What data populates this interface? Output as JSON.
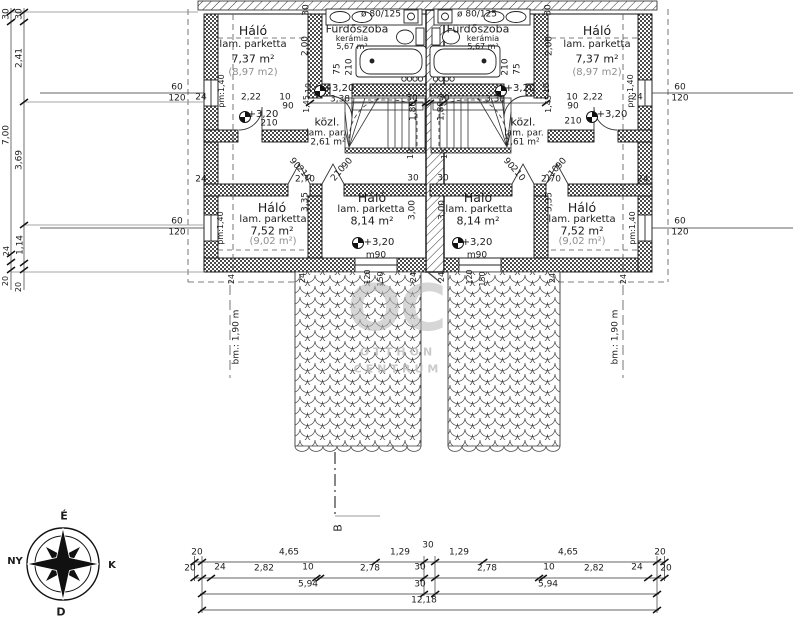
{
  "colors": {
    "line": "#1c1c1c",
    "gray_text": "#8f8f8f",
    "watermark": "#b5b5b5"
  },
  "labels": [
    {
      "n": "room-name-halo-top-left",
      "t": "Háló",
      "x": 253,
      "y": 31,
      "c": "s12"
    },
    {
      "n": "room-floor-halo-top-left",
      "t": "lam. parketta",
      "x": 253,
      "y": 45,
      "c": "s10"
    },
    {
      "n": "room-area-halo-top-left",
      "t": "7,37 m²",
      "x": 253,
      "y": 59,
      "c": "s11"
    },
    {
      "n": "room-area-gross-halo-top-left",
      "t": "(8,97 m2)",
      "x": 253,
      "y": 73,
      "c": "s10 gray"
    },
    {
      "n": "room-name-bathroom-left",
      "t": "Fürdőszoba",
      "x": 357,
      "y": 29,
      "c": "s11"
    },
    {
      "n": "room-floor-bathroom-left",
      "t": "kerámia",
      "x": 352,
      "y": 39,
      "c": "s8"
    },
    {
      "n": "room-area-bathroom-left",
      "t": "5,67 m²",
      "x": 352,
      "y": 47,
      "c": "s8"
    },
    {
      "n": "vent-label-left",
      "t": "ø 80/125",
      "x": 381,
      "y": 15,
      "c": "s9"
    },
    {
      "n": "room-name-hall-left",
      "t": "közl.",
      "x": 327,
      "y": 122,
      "c": "s11"
    },
    {
      "n": "room-floor-hall-left",
      "t": "lam. par.",
      "x": 326,
      "y": 134,
      "c": "s9"
    },
    {
      "n": "room-area-hall-left",
      "t": "2,61 m²",
      "x": 328,
      "y": 143,
      "c": "s9"
    },
    {
      "n": "room-name-halo-bottom-inner-left",
      "t": "Háló",
      "x": 372,
      "y": 198,
      "c": "s12"
    },
    {
      "n": "room-floor-halo-bottom-inner-left",
      "t": "lam. parketta",
      "x": 371,
      "y": 210,
      "c": "s10"
    },
    {
      "n": "room-area-halo-bottom-inner-left",
      "t": "8,14 m²",
      "x": 372,
      "y": 221,
      "c": "s11"
    },
    {
      "n": "level-label",
      "t": "+3,20",
      "x": 379,
      "y": 243,
      "c": "s10"
    },
    {
      "n": "door-label",
      "t": "m90",
      "x": 376,
      "y": 256,
      "c": "s9"
    },
    {
      "n": "room-name-halo-bottom-outer-left",
      "t": "Háló",
      "x": 272,
      "y": 208,
      "c": "s12"
    },
    {
      "n": "room-floor-halo-bottom-outer-left",
      "t": "lam. parketta",
      "x": 273,
      "y": 220,
      "c": "s10"
    },
    {
      "n": "room-area-halo-bottom-outer-left",
      "t": "7,52 m²",
      "x": 272,
      "y": 231,
      "c": "s11"
    },
    {
      "n": "room-area-gross-halo-bottom-outer-left",
      "t": "(9,02 m²)",
      "x": 273,
      "y": 242,
      "c": "s10 gray"
    },
    {
      "n": "room-name-halo-top-right",
      "t": "Háló",
      "x": 597,
      "y": 31,
      "c": "s12"
    },
    {
      "n": "room-floor-halo-top-right",
      "t": "lam. parketta",
      "x": 597,
      "y": 45,
      "c": "s10"
    },
    {
      "n": "room-area-halo-top-right",
      "t": "7,37 m²",
      "x": 597,
      "y": 59,
      "c": "s11"
    },
    {
      "n": "room-area-gross-halo-top-right",
      "t": "(8,97 m2)",
      "x": 597,
      "y": 73,
      "c": "s10 gray"
    },
    {
      "n": "room-name-bathroom-right",
      "t": "Fürdőszoba",
      "x": 478,
      "y": 29,
      "c": "s11"
    },
    {
      "n": "room-floor-bathroom-right",
      "t": "kerámia",
      "x": 483,
      "y": 39,
      "c": "s8"
    },
    {
      "n": "room-area-bathroom-right",
      "t": "5,67 m²",
      "x": 483,
      "y": 47,
      "c": "s8"
    },
    {
      "n": "vent-label-right",
      "t": "ø 80/125",
      "x": 477,
      "y": 15,
      "c": "s9"
    },
    {
      "n": "room-name-hall-right",
      "t": "közl.",
      "x": 523,
      "y": 122,
      "c": "s11"
    },
    {
      "n": "room-floor-hall-right",
      "t": "lam. par.",
      "x": 524,
      "y": 134,
      "c": "s9"
    },
    {
      "n": "room-area-hall-right",
      "t": "2,61 m²",
      "x": 522,
      "y": 143,
      "c": "s9"
    },
    {
      "n": "room-name-halo-bottom-inner-right",
      "t": "Háló",
      "x": 478,
      "y": 198,
      "c": "s12"
    },
    {
      "n": "room-floor-halo-bottom-inner-right",
      "t": "lam. parketta",
      "x": 479,
      "y": 210,
      "c": "s10"
    },
    {
      "n": "room-area-halo-bottom-inner-right",
      "t": "8,14 m²",
      "x": 478,
      "y": 221,
      "c": "s11"
    },
    {
      "n": "level-label",
      "t": "+3,20",
      "x": 477,
      "y": 243,
      "c": "s10"
    },
    {
      "n": "door-label",
      "t": "m90",
      "x": 477,
      "y": 256,
      "c": "s9"
    },
    {
      "n": "room-name-halo-bottom-outer-right",
      "t": "Háló",
      "x": 582,
      "y": 208,
      "c": "s12"
    },
    {
      "n": "room-floor-halo-bottom-outer-right",
      "t": "lam. parketta",
      "x": 582,
      "y": 220,
      "c": "s10"
    },
    {
      "n": "room-area-halo-bottom-outer-right",
      "t": "7,52 m²",
      "x": 582,
      "y": 231,
      "c": "s11"
    },
    {
      "n": "room-area-gross-halo-bottom-outer-right",
      "t": "(9,02 m²)",
      "x": 582,
      "y": 242,
      "c": "s10 gray"
    },
    {
      "n": "dim-label",
      "t": "pm:1,40",
      "x": 222,
      "y": 91,
      "r": -90,
      "c": "s8"
    },
    {
      "n": "dim-label",
      "t": "24",
      "x": 201,
      "y": 98,
      "c": "s9"
    },
    {
      "n": "dim-label",
      "t": "2,22",
      "x": 251,
      "y": 98,
      "c": "s9"
    },
    {
      "n": "dim-label",
      "t": "10",
      "x": 285,
      "y": 98,
      "c": "s9"
    },
    {
      "n": "dim-label",
      "t": "90",
      "x": 288,
      "y": 107,
      "c": "s9"
    },
    {
      "n": "level-label",
      "t": "+3,20",
      "x": 263,
      "y": 115,
      "c": "s10"
    },
    {
      "n": "dim-label",
      "t": "210",
      "x": 269,
      "y": 124,
      "c": "s9"
    },
    {
      "n": "dim-label",
      "t": "1,45",
      "x": 307,
      "y": 104,
      "r": -90,
      "c": "s8"
    },
    {
      "n": "dim-label",
      "t": "10",
      "x": 309,
      "y": 88,
      "r": -90,
      "c": "s8"
    },
    {
      "n": "dim-label",
      "t": "30",
      "x": 307,
      "y": 10,
      "r": -90,
      "c": "s9"
    },
    {
      "n": "dim-label",
      "t": "2,00",
      "x": 306,
      "y": 46,
      "r": -90,
      "c": "s9"
    },
    {
      "n": "dim-label",
      "t": "75",
      "x": 338,
      "y": 69,
      "r": -90,
      "c": "s9"
    },
    {
      "n": "dim-label",
      "t": "210",
      "x": 350,
      "y": 67,
      "r": -90,
      "c": "s9"
    },
    {
      "n": "level-label",
      "t": "+3,20",
      "x": 339,
      "y": 89,
      "c": "s10"
    },
    {
      "n": "dim-label",
      "t": "3,38",
      "x": 340,
      "y": 100,
      "c": "s9"
    },
    {
      "n": "dim-label",
      "t": "30",
      "x": 412,
      "y": 99,
      "c": "s9"
    },
    {
      "n": "dim-label",
      "t": "1,80",
      "x": 414,
      "y": 111,
      "r": -90,
      "c": "s9"
    },
    {
      "n": "dim-label",
      "t": "10",
      "x": 411,
      "y": 154,
      "r": -90,
      "c": "s8"
    },
    {
      "n": "dim-label",
      "t": "30",
      "x": 413,
      "y": 179,
      "c": "s9"
    },
    {
      "n": "dim-label",
      "t": "2,70",
      "x": 305,
      "y": 180,
      "c": "s9"
    },
    {
      "n": "door-size-label",
      "t": "90",
      "x": 294,
      "y": 164,
      "r": 50,
      "c": "s9"
    },
    {
      "n": "door-size-label",
      "t": "210",
      "x": 303,
      "y": 174,
      "r": 50,
      "c": "s9"
    },
    {
      "n": "door-size-label",
      "t": "90",
      "x": 348,
      "y": 164,
      "r": -50,
      "c": "s9"
    },
    {
      "n": "door-size-label",
      "t": "210",
      "x": 339,
      "y": 174,
      "r": -50,
      "c": "s9"
    },
    {
      "n": "dim-label",
      "t": "3,35",
      "x": 306,
      "y": 202,
      "r": -90,
      "c": "s9"
    },
    {
      "n": "dim-label",
      "t": "pm:1,40",
      "x": 221,
      "y": 228,
      "r": -90,
      "c": "s8"
    },
    {
      "n": "dim-label",
      "t": "3,00",
      "x": 413,
      "y": 210,
      "r": -90,
      "c": "s9"
    },
    {
      "n": "dim-label",
      "t": "24",
      "x": 201,
      "y": 180,
      "c": "s9"
    },
    {
      "n": "window-size-label",
      "t": "60",
      "x": 177,
      "y": 88,
      "c": "s9"
    },
    {
      "n": "window-size-label",
      "t": "120",
      "x": 177,
      "y": 99,
      "c": "s9"
    },
    {
      "n": "window-size-label",
      "t": "60",
      "x": 177,
      "y": 222,
      "c": "s9"
    },
    {
      "n": "window-size-label",
      "t": "120",
      "x": 177,
      "y": 233,
      "c": "s9"
    },
    {
      "n": "dim-label",
      "t": "24",
      "x": 232,
      "y": 279,
      "r": -90,
      "c": "s8"
    },
    {
      "n": "dim-label",
      "t": "24",
      "x": 303,
      "y": 278,
      "r": -90,
      "c": "s8"
    },
    {
      "n": "dim-label",
      "t": "24",
      "x": 414,
      "y": 277,
      "r": -90,
      "c": "s8"
    },
    {
      "n": "dim-label",
      "t": "120",
      "x": 368,
      "y": 277,
      "r": -90,
      "c": "s8"
    },
    {
      "n": "dim-label",
      "t": "150",
      "x": 381,
      "y": 279,
      "r": -90,
      "c": "s8"
    },
    {
      "n": "height-line-label-left",
      "t": "bm.: 1,90 m",
      "x": 237,
      "y": 337,
      "r": -90,
      "c": "s9"
    },
    {
      "n": "dim-label",
      "t": "pm:1,40",
      "x": 631,
      "y": 91,
      "r": -90,
      "c": "s8"
    },
    {
      "n": "dim-label",
      "t": "24",
      "x": 637,
      "y": 98,
      "c": "s9"
    },
    {
      "n": "dim-label",
      "t": "2,22",
      "x": 593,
      "y": 98,
      "c": "s9"
    },
    {
      "n": "dim-label",
      "t": "10",
      "x": 572,
      "y": 98,
      "c": "s9"
    },
    {
      "n": "dim-label",
      "t": "90",
      "x": 573,
      "y": 107,
      "c": "s9"
    },
    {
      "n": "dim-label",
      "t": "210",
      "x": 573,
      "y": 122,
      "c": "s9"
    },
    {
      "n": "level-label",
      "t": "+3,20",
      "x": 612,
      "y": 115,
      "c": "s10"
    },
    {
      "n": "dim-label",
      "t": "1,45",
      "x": 549,
      "y": 104,
      "r": -90,
      "c": "s8"
    },
    {
      "n": "dim-label",
      "t": "10",
      "x": 547,
      "y": 88,
      "r": -90,
      "c": "s8"
    },
    {
      "n": "dim-label",
      "t": "30",
      "x": 549,
      "y": 10,
      "r": -90,
      "c": "s9"
    },
    {
      "n": "dim-label",
      "t": "2,00",
      "x": 550,
      "y": 46,
      "r": -90,
      "c": "s9"
    },
    {
      "n": "dim-label",
      "t": "75",
      "x": 518,
      "y": 69,
      "r": -90,
      "c": "s9"
    },
    {
      "n": "dim-label",
      "t": "210",
      "x": 506,
      "y": 67,
      "r": -90,
      "c": "s9"
    },
    {
      "n": "level-label",
      "t": "+3,20",
      "x": 520,
      "y": 89,
      "c": "s10"
    },
    {
      "n": "dim-label",
      "t": "3,38",
      "x": 495,
      "y": 100,
      "c": "s9"
    },
    {
      "n": "dim-label",
      "t": "30",
      "x": 444,
      "y": 99,
      "c": "s9"
    },
    {
      "n": "dim-label",
      "t": "1,80",
      "x": 442,
      "y": 111,
      "r": -90,
      "c": "s9"
    },
    {
      "n": "dim-label",
      "t": "10",
      "x": 445,
      "y": 154,
      "r": -90,
      "c": "s8"
    },
    {
      "n": "dim-label",
      "t": "30",
      "x": 443,
      "y": 179,
      "c": "s9"
    },
    {
      "n": "dim-label",
      "t": "2,70",
      "x": 551,
      "y": 180,
      "c": "s9"
    },
    {
      "n": "door-size-label",
      "t": "90",
      "x": 562,
      "y": 164,
      "r": -50,
      "c": "s9"
    },
    {
      "n": "door-size-label",
      "t": "210",
      "x": 553,
      "y": 174,
      "r": -50,
      "c": "s9"
    },
    {
      "n": "door-size-label",
      "t": "90",
      "x": 508,
      "y": 164,
      "r": 50,
      "c": "s9"
    },
    {
      "n": "door-size-label",
      "t": "210",
      "x": 517,
      "y": 174,
      "r": 50,
      "c": "s9"
    },
    {
      "n": "dim-label",
      "t": "3,35",
      "x": 550,
      "y": 202,
      "r": -90,
      "c": "s9"
    },
    {
      "n": "dim-label",
      "t": "pm:1,40",
      "x": 633,
      "y": 228,
      "r": -90,
      "c": "s8"
    },
    {
      "n": "dim-label",
      "t": "3,00",
      "x": 443,
      "y": 210,
      "r": -90,
      "c": "s9"
    },
    {
      "n": "dim-label",
      "t": "24",
      "x": 643,
      "y": 180,
      "c": "s9"
    },
    {
      "n": "window-size-label",
      "t": "60",
      "x": 680,
      "y": 88,
      "c": "s9"
    },
    {
      "n": "window-size-label",
      "t": "120",
      "x": 680,
      "y": 99,
      "c": "s9"
    },
    {
      "n": "window-size-label",
      "t": "60",
      "x": 680,
      "y": 222,
      "c": "s9"
    },
    {
      "n": "window-size-label",
      "t": "120",
      "x": 680,
      "y": 233,
      "c": "s9"
    },
    {
      "n": "dim-label",
      "t": "24",
      "x": 624,
      "y": 279,
      "r": -90,
      "c": "s8"
    },
    {
      "n": "dim-label",
      "t": "24",
      "x": 553,
      "y": 278,
      "r": -90,
      "c": "s8"
    },
    {
      "n": "dim-label",
      "t": "24",
      "x": 442,
      "y": 277,
      "r": -90,
      "c": "s8"
    },
    {
      "n": "dim-label",
      "t": "120",
      "x": 470,
      "y": 277,
      "r": -90,
      "c": "s8"
    },
    {
      "n": "dim-label",
      "t": "150",
      "x": 483,
      "y": 279,
      "r": -90,
      "c": "s8"
    },
    {
      "n": "height-line-label-right",
      "t": "bm.: 1,90 m",
      "x": 616,
      "y": 337,
      "r": -90,
      "c": "s9"
    },
    {
      "n": "dim-label",
      "t": "30",
      "x": 7,
      "y": 14,
      "r": -90,
      "c": "s9"
    },
    {
      "n": "dim-label",
      "t": "30",
      "x": 20,
      "y": 14,
      "r": -90,
      "c": "s9"
    },
    {
      "n": "dim-label",
      "t": "2,41",
      "x": 20,
      "y": 58,
      "r": -90,
      "c": "s9"
    },
    {
      "n": "dim-label",
      "t": "7,00",
      "x": 7,
      "y": 135,
      "r": -90,
      "c": "s9"
    },
    {
      "n": "dim-label",
      "t": "3,69",
      "x": 20,
      "y": 160,
      "r": -90,
      "c": "s9"
    },
    {
      "n": "dim-label",
      "t": "1,14",
      "x": 21,
      "y": 245,
      "r": -90,
      "c": "s9"
    },
    {
      "n": "dim-label",
      "t": "24",
      "x": 7,
      "y": 251,
      "r": -90,
      "c": "s8"
    },
    {
      "n": "dim-label",
      "t": "20",
      "x": 6,
      "y": 281,
      "r": -90,
      "c": "s8"
    },
    {
      "n": "dim-label",
      "t": "20",
      "x": 19,
      "y": 287,
      "r": -90,
      "c": "s8"
    },
    {
      "n": "dim-label",
      "t": "20",
      "x": 197,
      "y": 553,
      "c": "s9"
    },
    {
      "n": "dim-label",
      "t": "4,65",
      "x": 289,
      "y": 553,
      "c": "s9"
    },
    {
      "n": "dim-label",
      "t": "1,29",
      "x": 400,
      "y": 553,
      "c": "s9"
    },
    {
      "n": "dim-label",
      "t": "30",
      "x": 428,
      "y": 546,
      "c": "s9"
    },
    {
      "n": "dim-label",
      "t": "1,29",
      "x": 459,
      "y": 553,
      "c": "s9"
    },
    {
      "n": "dim-label",
      "t": "4,65",
      "x": 568,
      "y": 553,
      "c": "s9"
    },
    {
      "n": "dim-label",
      "t": "20",
      "x": 660,
      "y": 553,
      "c": "s9"
    },
    {
      "n": "dim-label",
      "t": "20",
      "x": 190,
      "y": 569,
      "c": "s9"
    },
    {
      "n": "dim-label",
      "t": "24",
      "x": 220,
      "y": 568,
      "c": "s9"
    },
    {
      "n": "dim-label",
      "t": "2,82",
      "x": 264,
      "y": 569,
      "c": "s9"
    },
    {
      "n": "dim-label",
      "t": "10",
      "x": 308,
      "y": 568,
      "c": "s9"
    },
    {
      "n": "dim-label",
      "t": "2,78",
      "x": 370,
      "y": 569,
      "c": "s9"
    },
    {
      "n": "dim-label",
      "t": "30",
      "x": 420,
      "y": 568,
      "c": "s9"
    },
    {
      "n": "dim-label",
      "t": "2,78",
      "x": 487,
      "y": 569,
      "c": "s9"
    },
    {
      "n": "dim-label",
      "t": "10",
      "x": 549,
      "y": 568,
      "c": "s9"
    },
    {
      "n": "dim-label",
      "t": "2,82",
      "x": 594,
      "y": 569,
      "c": "s9"
    },
    {
      "n": "dim-label",
      "t": "24",
      "x": 637,
      "y": 568,
      "c": "s9"
    },
    {
      "n": "dim-label",
      "t": "20",
      "x": 666,
      "y": 569,
      "c": "s9"
    },
    {
      "n": "dim-label",
      "t": "5,94",
      "x": 308,
      "y": 585,
      "c": "s9"
    },
    {
      "n": "dim-label",
      "t": "30",
      "x": 420,
      "y": 585,
      "c": "s9"
    },
    {
      "n": "dim-label",
      "t": "5,94",
      "x": 548,
      "y": 585,
      "c": "s9"
    },
    {
      "n": "dim-label",
      "t": "12,18",
      "x": 424,
      "y": 601,
      "c": "s9"
    },
    {
      "n": "section-mark-label",
      "t": "B",
      "x": 338,
      "y": 528,
      "r": -90,
      "c": "s11"
    },
    {
      "n": "compass-north-label",
      "t": "É",
      "x": 64,
      "y": 516,
      "c": "s11 b"
    },
    {
      "n": "compass-west-label",
      "t": "NY",
      "x": 15,
      "y": 562,
      "c": "s10 b"
    },
    {
      "n": "compass-east-label",
      "t": "K",
      "x": 112,
      "y": 566,
      "c": "s10 b"
    },
    {
      "n": "compass-south-label",
      "t": "D",
      "x": 61,
      "y": 612,
      "c": "s11 b"
    },
    {
      "n": "watermark-logo",
      "t": "OC",
      "x": 396,
      "y": 309,
      "c": "wm1"
    },
    {
      "n": "watermark-text-line1",
      "t": "OTTHON",
      "x": 398,
      "y": 352,
      "c": "wm2"
    },
    {
      "n": "watermark-text-line2",
      "t": "CENTRUM",
      "x": 398,
      "y": 369,
      "c": "wm2"
    }
  ]
}
